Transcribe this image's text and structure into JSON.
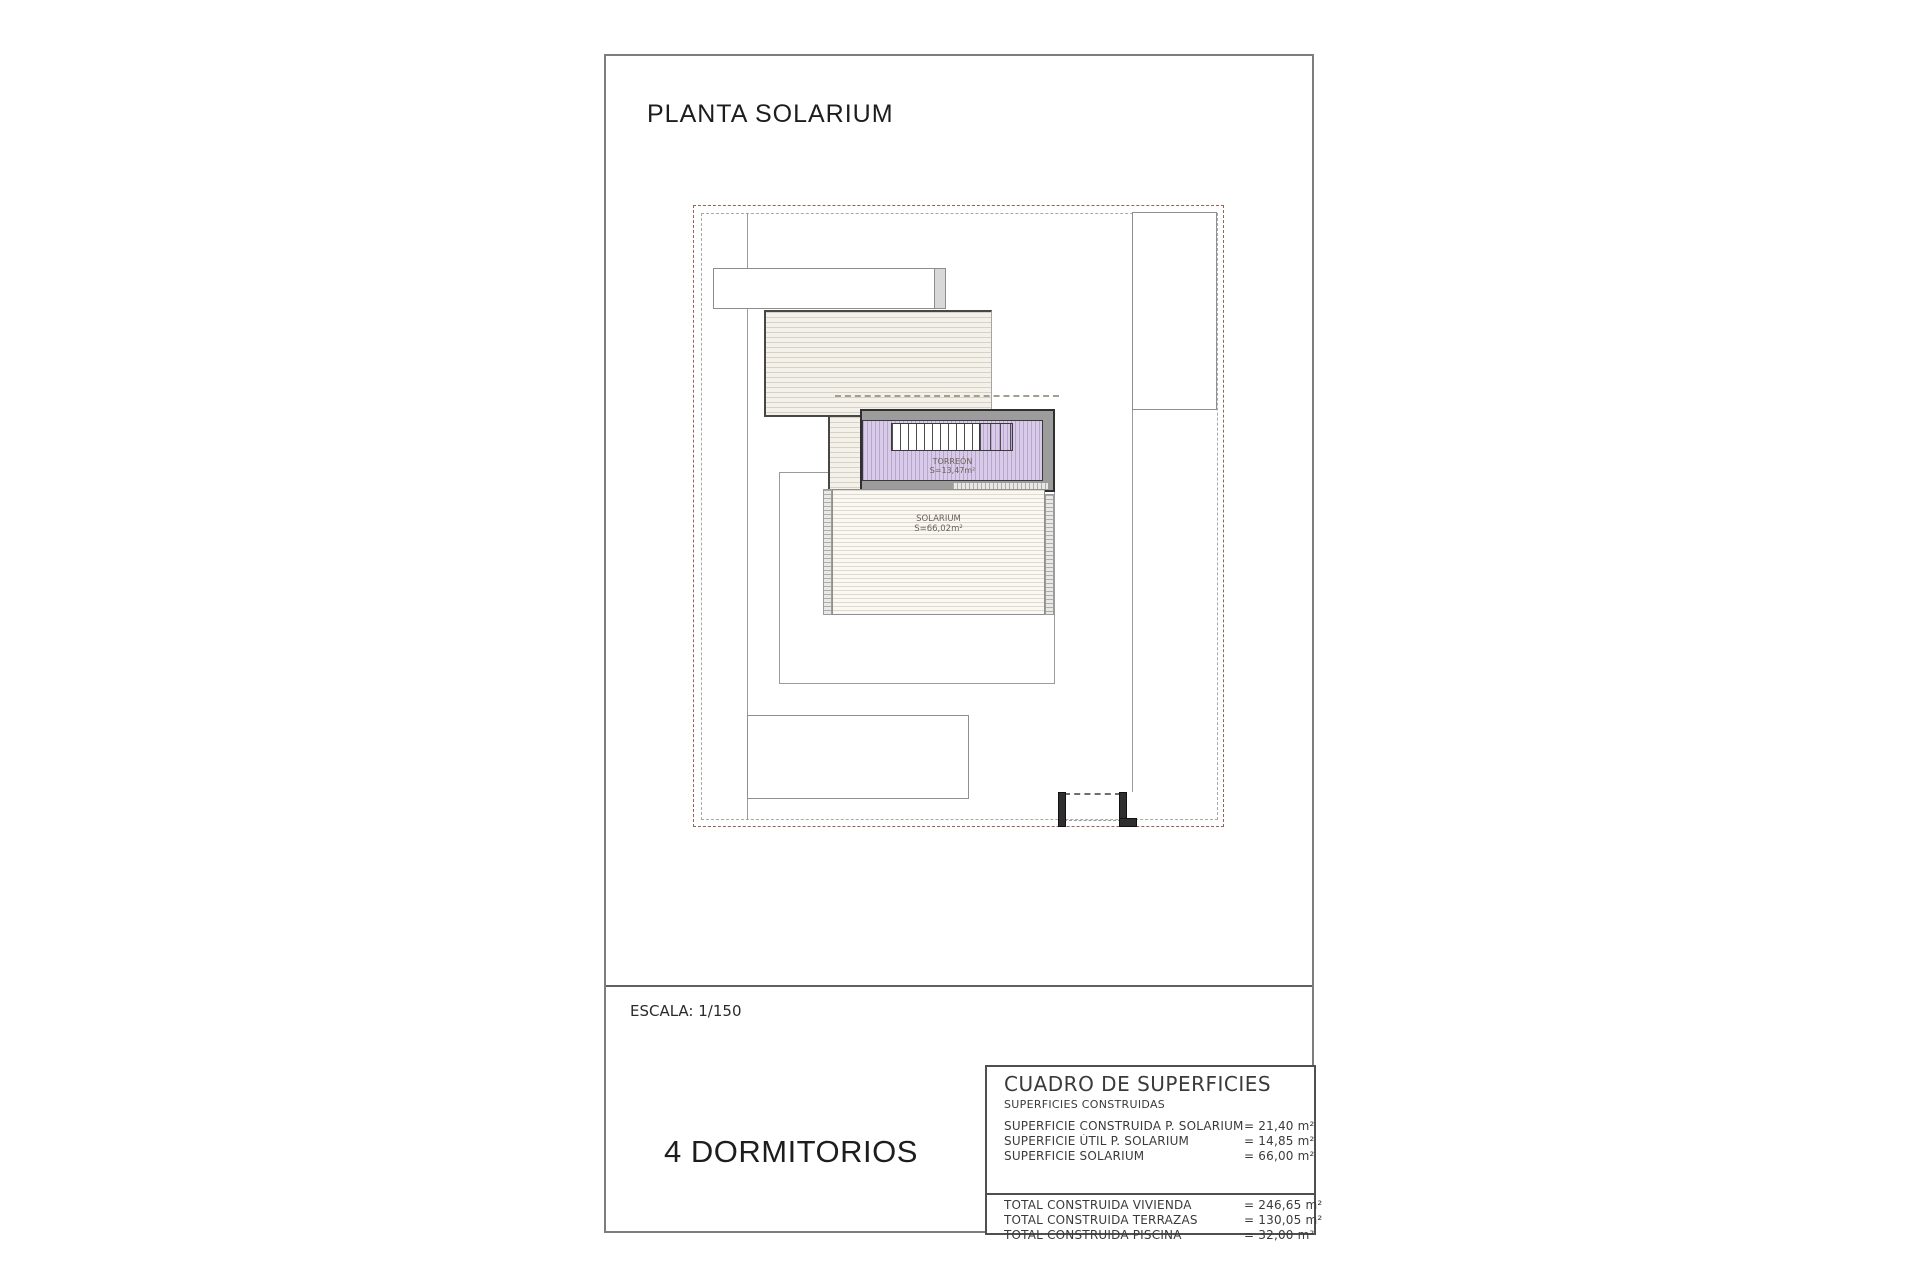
{
  "page": {
    "title": "PLANTA SOLARIUM",
    "scale": "ESCALA: 1/150",
    "bedrooms": "4 DORMITORIOS"
  },
  "plan": {
    "torreon": {
      "name": "TORREÓN",
      "area": "S=13,47m²"
    },
    "solarium": {
      "name": "SOLARIUM",
      "area": "S=66,02m²"
    }
  },
  "surfaces_table": {
    "title": "CUADRO DE SUPERFICIES",
    "subtitle": "SUPERFICIES CONSTRUIDAS",
    "rows": [
      {
        "label": "SUPERFICIE CONSTRUIDA P. SOLARIUM",
        "value": "= 21,40 m²"
      },
      {
        "label": "SUPERFICIE ÚTIL P. SOLARIUM",
        "value": "= 14,85 m²"
      },
      {
        "label": "SUPERFICIE SOLARIUM",
        "value": "= 66,00 m²"
      }
    ],
    "totals": [
      {
        "label": "TOTAL CONSTRUIDA VIVIENDA",
        "value": "= 246,65 m²"
      },
      {
        "label": "TOTAL CONSTRUIDA TERRAZAS",
        "value": "= 130,05 m²"
      },
      {
        "label": "TOTAL CONSTRUIDA PISCINA",
        "value": "= 32,00 m²"
      }
    ]
  },
  "colors": {
    "boundary_dashdot": "#96655a",
    "boundary_inner": "#a9a9a9",
    "wall_dark": "#2f2f2f",
    "band_gray": "#9c9c9c",
    "torreon_fill": "#d7cbe7",
    "torreon_stripe": "#b5a5cf",
    "roof_hatch_line": "#d8d0c2",
    "sheet_border": "#7d7d7d"
  }
}
